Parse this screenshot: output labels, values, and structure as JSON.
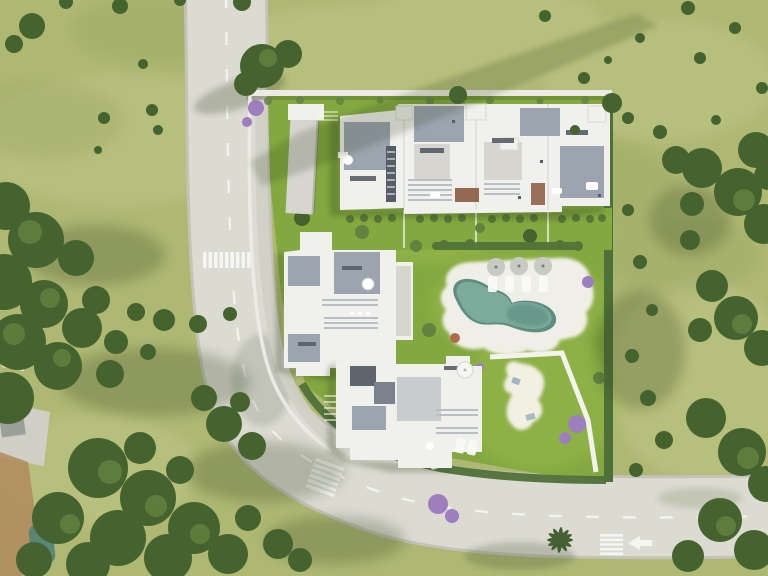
{
  "scene": {
    "description": "Aerial 3D render of a residential development: three white flat-roof building blocks inside a walled plot with a free-form swimming pool, sun deck with parasols, lawns, a sand play area, a curved road with lane markings and crosswalks, and surrounding fields with trees",
    "building_block_count": 3,
    "parasol_count": 3,
    "crosswalk_count": 3,
    "pool_shape": "free-form kidney"
  },
  "palette": {
    "grass_field": "#aeb873",
    "grass_light": "#c9cd8f",
    "grass_dark": "#93a05c",
    "lawn": "#82a83f",
    "lawn_bright": "#a6c254",
    "road": "#dcdbd2",
    "road_edge": "#c3c3b8",
    "marking": "#f8f8f4",
    "roof_white": "#f0f0ec",
    "roof_warm": "#d7d5d0",
    "roof_gray": "#9ba4af",
    "roof_dark": "#565d66",
    "wall_white": "#eceae4",
    "concrete": "#cfcfc5",
    "hedge": "#4f7038",
    "tree": "#45632f",
    "tree_light": "#628340",
    "shadow": "#32401f",
    "pool_water": "#7cab9b",
    "pool_deep": "#4f8276",
    "deck": "#f0efe7",
    "sand": "#f2efe3",
    "purple": "#9d7fc0",
    "dirt": "#b18a5c",
    "wood": "#8a5a40",
    "bush_red": "#b06a4a"
  }
}
